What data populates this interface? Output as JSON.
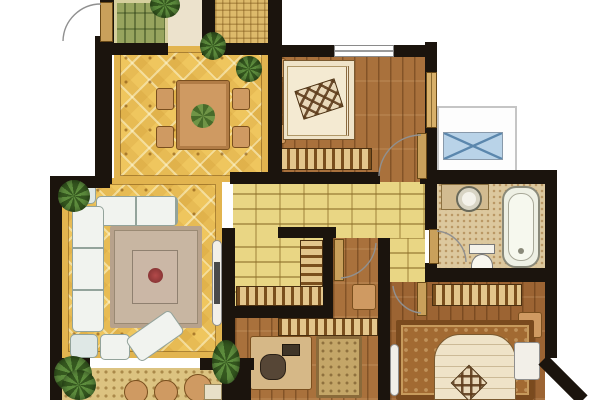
{
  "meta": {
    "title": "apartment-floor-plan",
    "canvas_width": 600,
    "canvas_height": 400,
    "visible_text": "none"
  },
  "palette": {
    "wall": "#1b140d",
    "floorDiamond": "#efc65e",
    "tileBorder": "#e2b44f",
    "brick": "#e9d684",
    "wood1": "#a9713c",
    "woodMaster": "#9c6433",
    "green": "#97a45e",
    "cream": "#ece2cc",
    "tanGrid": "#ddba6b",
    "bath": "#dcc89e",
    "balcony": "#dcc381",
    "stripeDark": "#7a4f1e",
    "stripeLight": "#e3c68c",
    "sofa": "#f1f3ef",
    "rugLiving": "#c8b6a2",
    "rugMaster": "#a26a32",
    "rugB2": "#c4a668",
    "bedCream": "#efe3c8",
    "furnTan": "#cf9a62",
    "acBlue": "#b9d3e8",
    "acLine": "#5b87ad",
    "leaf": "#c9a05b",
    "plantDark": "#35581f",
    "plantLight": "#5d8c3d",
    "flower": "#b34a4a"
  },
  "rooms": {
    "kitchen": {
      "name": "green parquet room (kitchen/deck)",
      "floor": "green-parquet"
    },
    "foyer": {
      "name": "entry foyer",
      "floor": "cream"
    },
    "utility": {
      "name": "small utility balcony",
      "floor": "tan-grid-tile"
    },
    "dining": {
      "name": "dining room",
      "floor": "yellow-diamond-tile"
    },
    "living": {
      "name": "living room",
      "floor": "yellow-diamond-tile"
    },
    "corridor": {
      "name": "corridor",
      "floor": "yellow-brick-tile"
    },
    "closet": {
      "name": "storage closet",
      "floor": "yellow-brick-tile"
    },
    "bedroom1": {
      "name": "bedroom (top right)",
      "floor": "wood-plank"
    },
    "bedroom2": {
      "name": "bedroom / study (bottom middle)",
      "floor": "wood-plank"
    },
    "master": {
      "name": "master bedroom (bottom right)",
      "floor": "wood-plank"
    },
    "bathroom": {
      "name": "bathroom",
      "floor": "speckled-tile"
    },
    "balcony": {
      "name": "balcony (bottom left)",
      "floor": "pebble-tile"
    },
    "ac_platform": {
      "name": "a/c platform (outside right)",
      "floor": "none"
    }
  },
  "furniture": {
    "dining_table": "rectangular dining table with plant centerpiece and 4 chairs",
    "living_sofa": "L-shaped white sectional sofa with corner tables, coffee table on rug, chaise",
    "tv_cabinet": "white TV cabinet on living room east wall",
    "bed1": "double bed with headboard, 2 nightstands, diamond quilt",
    "wardrobe1": "striped wardrobe along bedroom-1 south wall",
    "closet_cabinets": "L-shaped striped cabinets in storage closet",
    "desk2": "desk with chair and rug in bedroom-2",
    "wardrobe2": "striped wardrobe along bedroom-2 north wall",
    "master_bed": "double bed on patterned rug, nightstand, white dresser",
    "wardrobe3": "striped wardrobe along master north wall",
    "bath_fixtures": "round basin with vanity, toilet, bathtub",
    "balcony_seats": "three round seats and potted plants",
    "plants": "potted plants at entries, living room corners, balcony"
  },
  "doors": {
    "entry": "top-left swing door with arc",
    "bedroom1": "swing door bottom-right of bedroom 1",
    "bathroom": "swing door on bathroom west wall",
    "bedroom2": "swing door from corridor",
    "master": "swing door from corridor end"
  },
  "windows": {
    "bedroom1_top": "window in bedroom-1 north wall",
    "bedroom1_right": "window in bedroom-1 east wall"
  }
}
